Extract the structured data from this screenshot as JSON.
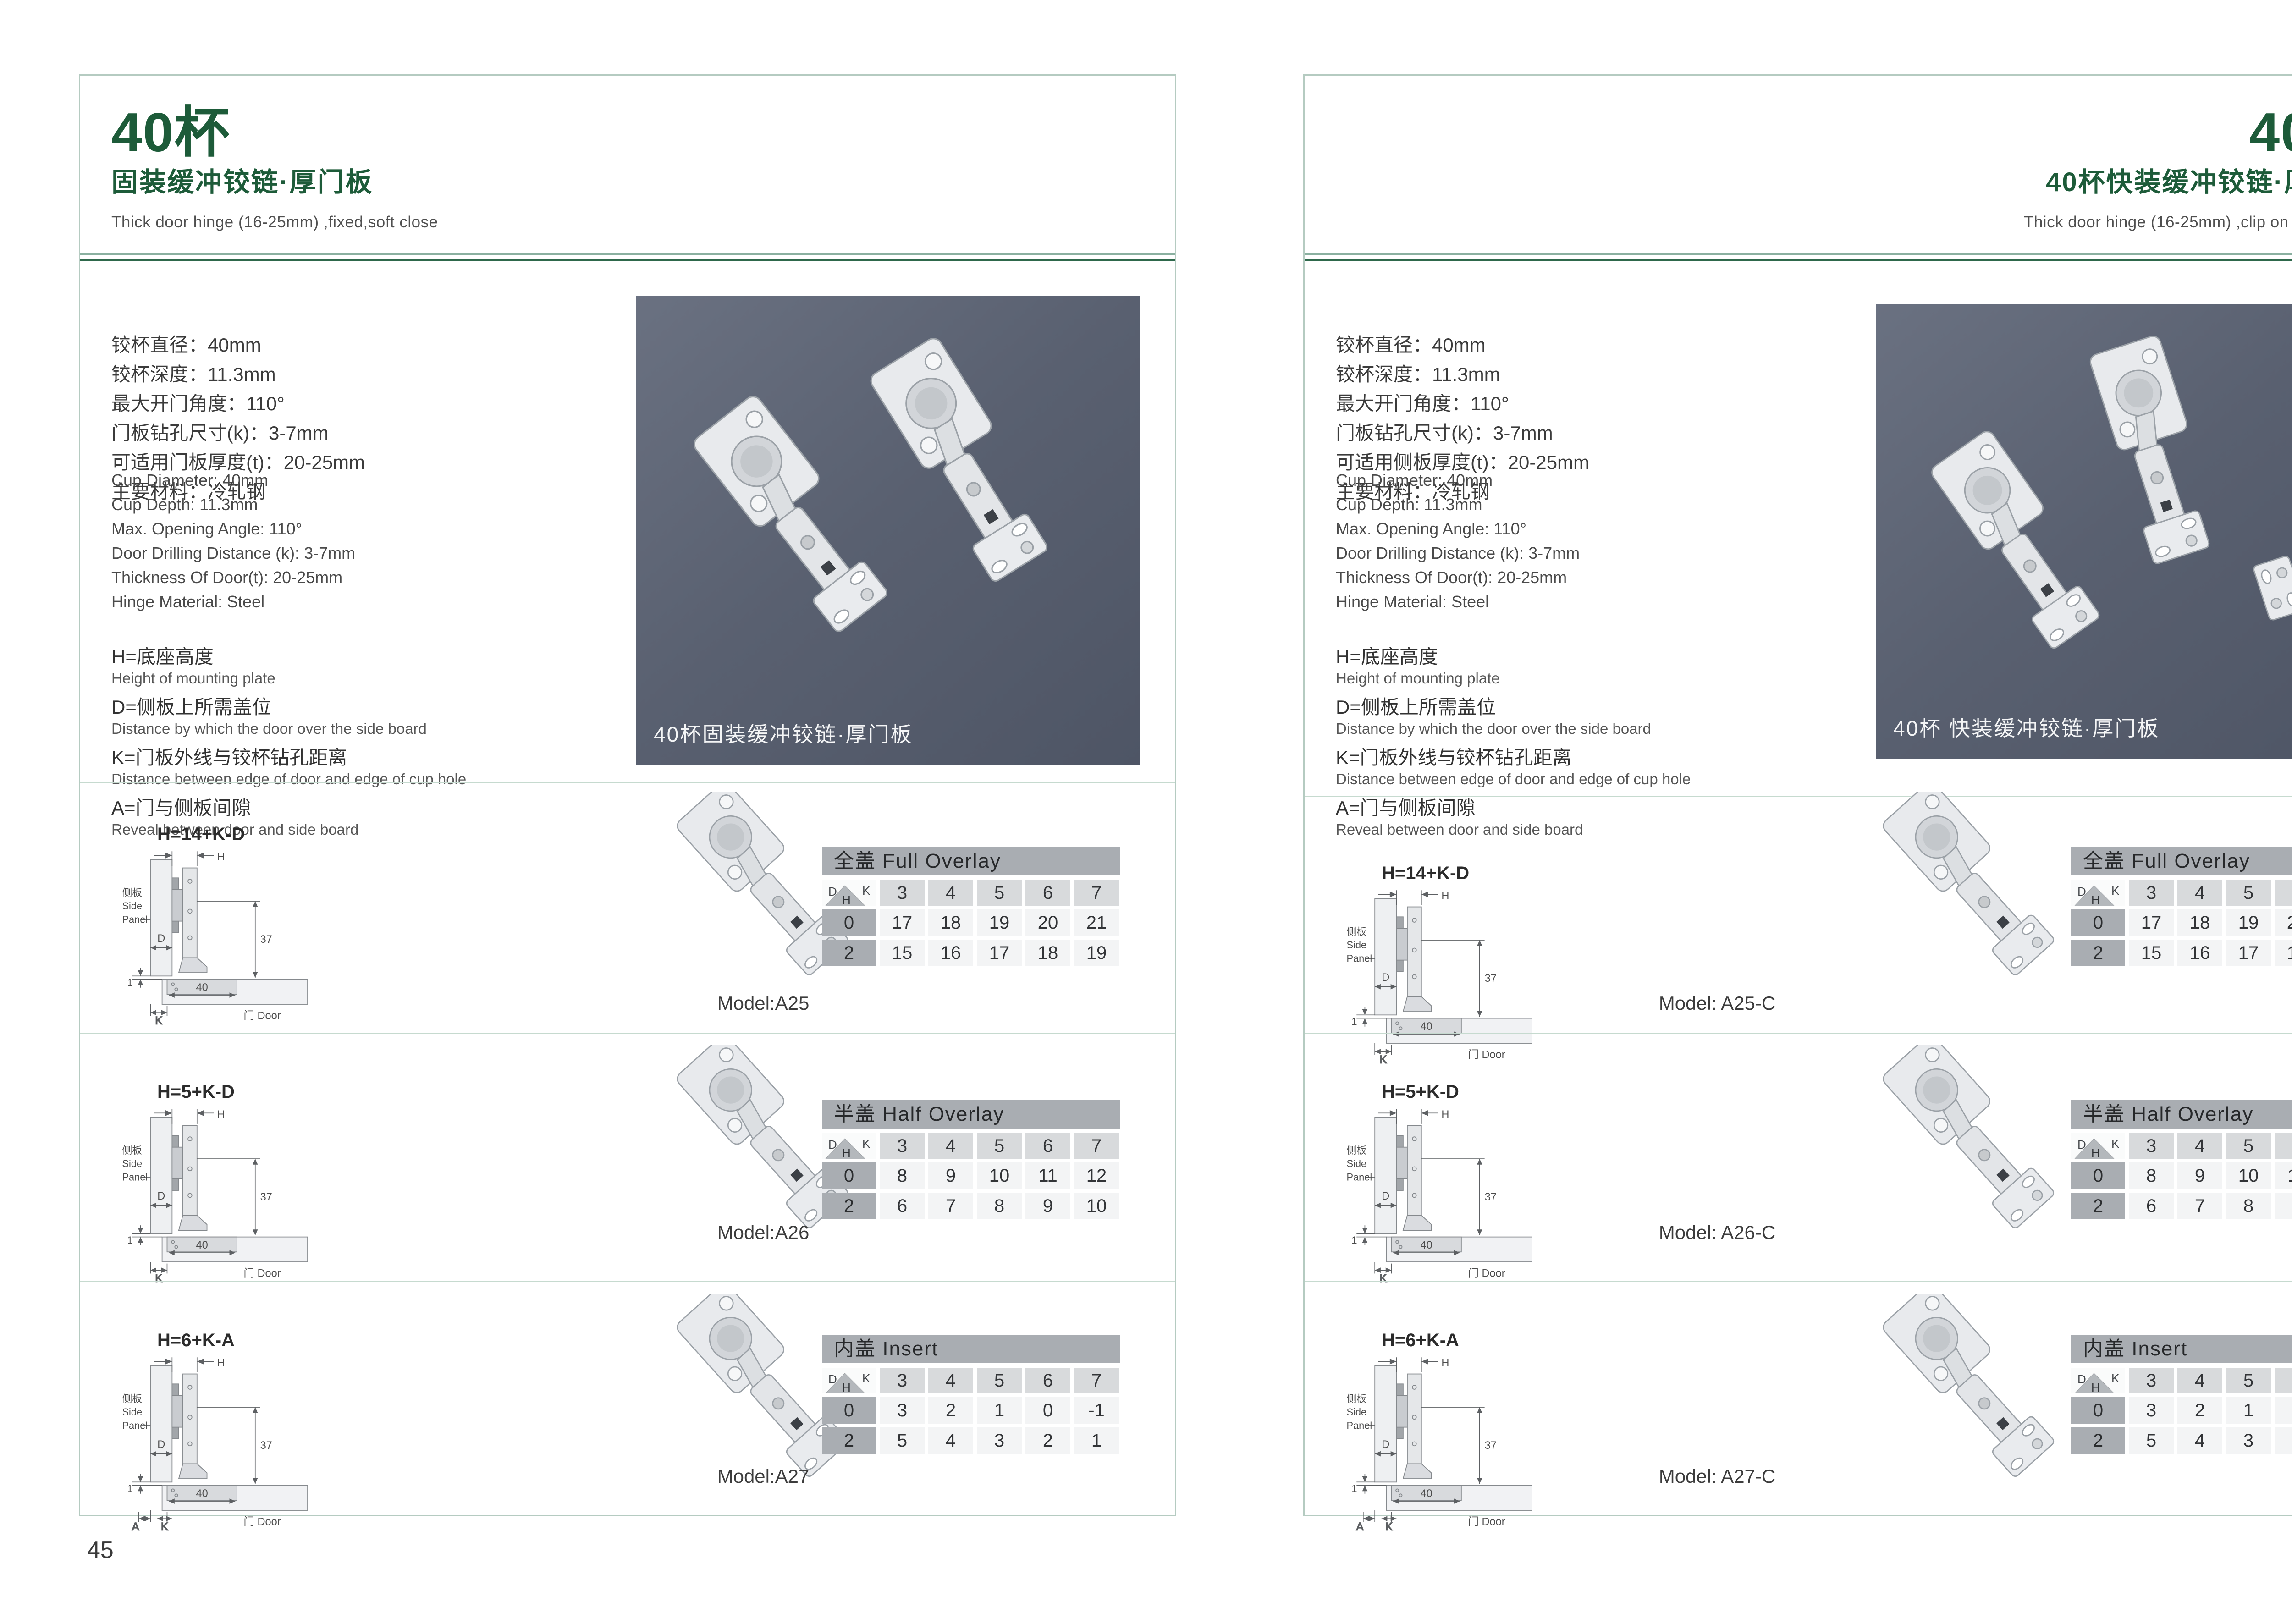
{
  "corner": {
    "d": "D",
    "k": "K",
    "h": "H"
  },
  "diagram_labels": {
    "side_cn": "侧板",
    "side_en1": "Side",
    "side_en2": "Panel",
    "door": "门 Door",
    "h": "H",
    "d": "D",
    "k": "K",
    "a": "A",
    "one": "1",
    "forty": "40",
    "thirty_seven": "37"
  },
  "pages": [
    {
      "page_number": "45",
      "header": {
        "title": "40杯",
        "subtitle": "固装缓冲铰链·厚门板",
        "subtitle_en": "Thick door hinge (16-25mm)  ,fixed,soft close"
      },
      "specs_cn": [
        "铰杯直径：40mm",
        "铰杯深度：11.3mm",
        "最大开门角度：110°",
        "门板钻孔尺寸(k)：3-7mm",
        "可适用门板厚度(t)：20-25mm",
        "主要材料：冷轧钢"
      ],
      "specs_en": [
        "Cup Diameter: 40mm",
        "Cup Depth: 11.3mm",
        "Max. Opening Angle: 110°",
        "Door Drilling Distance (k): 3-7mm",
        "Thickness Of Door(t): 20-25mm",
        "Hinge Material: Steel"
      ],
      "definitions": [
        {
          "cn": "H=底座高度",
          "en": "Height of mounting plate"
        },
        {
          "cn": "D=侧板上所需盖位",
          "en": "Distance by which the door over the side board"
        },
        {
          "cn": "K=门板外线与铰杯钻孔距离",
          "en": "Distance between edge of door and edge of cup hole"
        },
        {
          "cn": "A=门与侧板间隙",
          "en": "Reveal between door and side board"
        }
      ],
      "photo_caption": "40杯固装缓冲铰链·厚门板",
      "rows": [
        {
          "formula": "H=14+K-D",
          "model": "Model:A25",
          "table": {
            "title": "全盖 Full Overlay",
            "k": [
              "3",
              "4",
              "5",
              "6",
              "7"
            ],
            "body": [
              {
                "h": "0",
                "v": [
                  "17",
                  "18",
                  "19",
                  "20",
                  "21"
                ]
              },
              {
                "h": "2",
                "v": [
                  "15",
                  "16",
                  "17",
                  "18",
                  "19"
                ]
              }
            ]
          }
        },
        {
          "formula": "H=5+K-D",
          "model": "Model:A26",
          "table": {
            "title": "半盖 Half Overlay",
            "k": [
              "3",
              "4",
              "5",
              "6",
              "7"
            ],
            "body": [
              {
                "h": "0",
                "v": [
                  "8",
                  "9",
                  "10",
                  "11",
                  "12"
                ]
              },
              {
                "h": "2",
                "v": [
                  "6",
                  "7",
                  "8",
                  "9",
                  "10"
                ]
              }
            ]
          }
        },
        {
          "formula": "H=6+K-A",
          "model": "Model:A27",
          "table": {
            "title": "内盖 Insert",
            "k": [
              "3",
              "4",
              "5",
              "6",
              "7"
            ],
            "body": [
              {
                "h": "0",
                "v": [
                  "3",
                  "2",
                  "1",
                  "0",
                  "-1"
                ]
              },
              {
                "h": "2",
                "v": [
                  "5",
                  "4",
                  "3",
                  "2",
                  "1"
                ]
              }
            ]
          }
        }
      ]
    },
    {
      "page_number": "46",
      "header": {
        "title": "40杯",
        "subtitle": "40杯快装缓冲铰链·厚门板",
        "subtitle_en": "Thick door hinge (16-25mm)  ,clip on ,soft close"
      },
      "specs_cn": [
        "铰杯直径：40mm",
        "铰杯深度：11.3mm",
        "最大开门角度：110°",
        "门板钻孔尺寸(k)：3-7mm",
        "可适用侧板厚度(t)：20-25mm",
        "主要材料：冷轧钢"
      ],
      "specs_en": [
        "Cup Diameter: 40mm",
        "Cup Depth: 11.3mm",
        "Max. Opening Angle: 110°",
        "Door Drilling Distance (k): 3-7mm",
        "Thickness Of Door(t): 20-25mm",
        "Hinge Material: Steel"
      ],
      "definitions": [
        {
          "cn": "H=底座高度",
          "en": "Height of mounting plate"
        },
        {
          "cn": "D=侧板上所需盖位",
          "en": "Distance by which the door over the side board"
        },
        {
          "cn": "K=门板外线与铰杯钻孔距离",
          "en": "Distance between edge of door and edge of cup hole"
        },
        {
          "cn": "A=门与侧板间隙",
          "en": "Reveal between door and side board"
        }
      ],
      "photo_caption": "40杯 快装缓冲铰链·厚门板",
      "rows": [
        {
          "formula": "H=14+K-D",
          "model": "Model: A25-C",
          "table": {
            "title": "全盖 Full Overlay",
            "k": [
              "3",
              "4",
              "5",
              "6",
              "7"
            ],
            "body": [
              {
                "h": "0",
                "v": [
                  "17",
                  "18",
                  "19",
                  "20",
                  "21"
                ]
              },
              {
                "h": "2",
                "v": [
                  "15",
                  "16",
                  "17",
                  "18",
                  "19"
                ]
              }
            ]
          }
        },
        {
          "formula": "H=5+K-D",
          "model": "Model: A26-C",
          "table": {
            "title": "半盖 Half Overlay",
            "k": [
              "3",
              "4",
              "5",
              "6",
              "7"
            ],
            "body": [
              {
                "h": "0",
                "v": [
                  "8",
                  "9",
                  "10",
                  "11",
                  "12"
                ]
              },
              {
                "h": "2",
                "v": [
                  "6",
                  "7",
                  "8",
                  "9",
                  "10"
                ]
              }
            ]
          }
        },
        {
          "formula": "H=6+K-A",
          "model": "Model: A27-C",
          "table": {
            "title": "内盖 Insert",
            "k": [
              "3",
              "4",
              "5",
              "6",
              "7"
            ],
            "body": [
              {
                "h": "0",
                "v": [
                  "3",
                  "2",
                  "1",
                  "0",
                  "-1"
                ]
              },
              {
                "h": "2",
                "v": [
                  "5",
                  "4",
                  "3",
                  "2",
                  "1"
                ]
              }
            ]
          }
        }
      ]
    }
  ]
}
